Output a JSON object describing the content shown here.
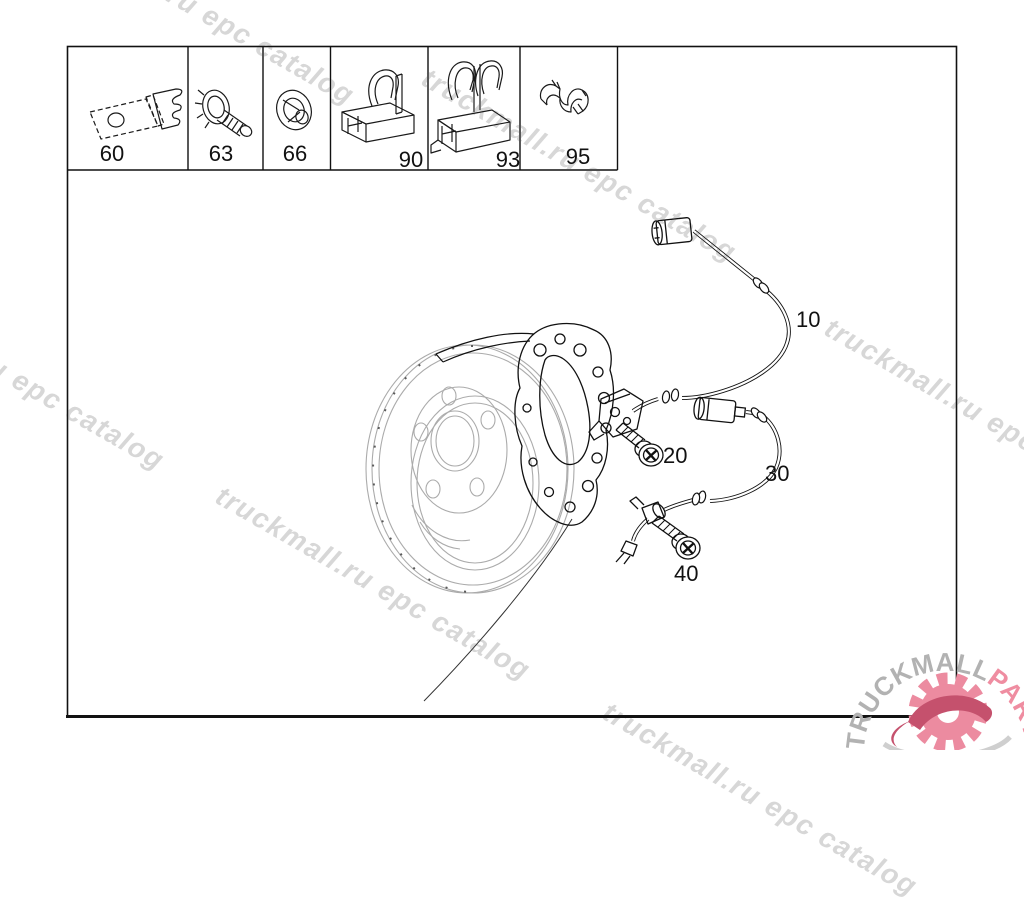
{
  "page": {
    "background": "#ffffff",
    "line_color": "#1a1a1a",
    "diagram_gray": "#ababab"
  },
  "watermark": {
    "text": "truckmall.ru epc catalog",
    "color": "#d7d7d7"
  },
  "logo": {
    "brand": "TRUCKMALL",
    "suffix": "PARTS",
    "brand_color": "#b2b2b2",
    "suffix_color": "#ef8da1",
    "gear_color": "#ec8ba0",
    "swoosh_color": "#c5516d",
    "under_swoosh_color": "#cfcfcf"
  },
  "parts_table": {
    "cells": [
      {
        "label": "60"
      },
      {
        "label": "63"
      },
      {
        "label": "66"
      },
      {
        "label": "90"
      },
      {
        "label": "93"
      },
      {
        "label": "95"
      }
    ]
  },
  "diagram": {
    "callouts": [
      {
        "label": "10"
      },
      {
        "label": "20"
      },
      {
        "label": "30"
      },
      {
        "label": "40"
      }
    ]
  }
}
